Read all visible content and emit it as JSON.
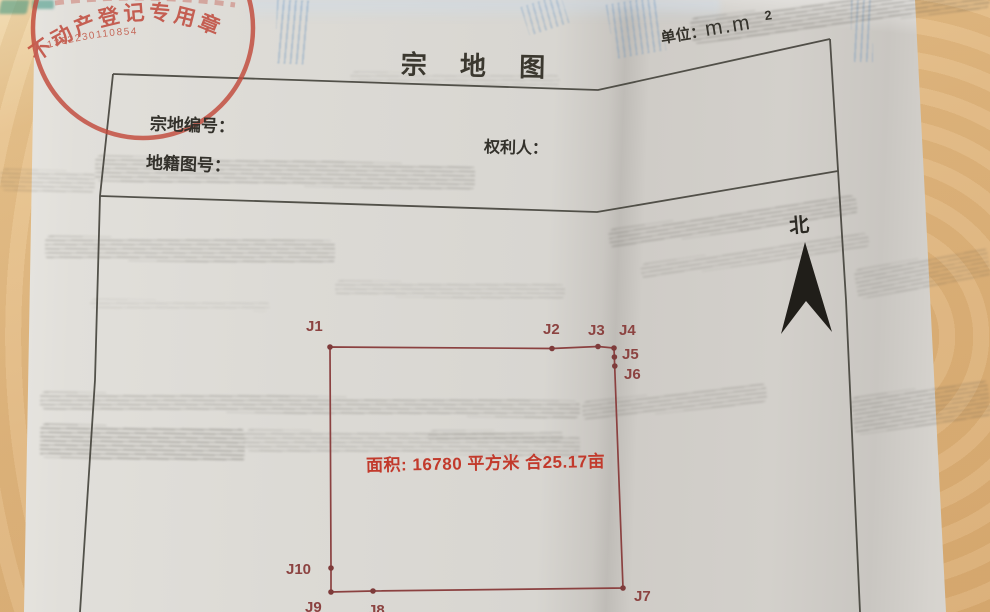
{
  "document": {
    "title": "宗 地 图",
    "unit_prefix": "单位：",
    "unit_value": "m.m",
    "unit_exponent": "2",
    "field_parcel_number": "宗地编号：",
    "field_cadastral_number": "地籍图号：",
    "field_rights_holder": "权利人：",
    "north_label": "北",
    "area_label": "面积: 16780 平方米 合25.17亩"
  },
  "seal": {
    "ring_text": "不动产登记专用章",
    "serial_number": "1302230110854"
  },
  "parcel": {
    "area_sqm": "16780",
    "area_mu": "25.17",
    "boundary_points": [
      {
        "label": "J1"
      },
      {
        "label": "J2"
      },
      {
        "label": "J3"
      },
      {
        "label": "J4"
      },
      {
        "label": "J5"
      },
      {
        "label": "J6"
      },
      {
        "label": "J7"
      },
      {
        "label": "J8"
      },
      {
        "label": "J9"
      },
      {
        "label": "J10"
      }
    ]
  },
  "colors": {
    "boundary": "#8b4140",
    "area_text": "#c23a2c",
    "seal": "#c04438",
    "table_background": "#e0b77e",
    "paper": "#dbd9d4",
    "ink": "#33312b"
  }
}
